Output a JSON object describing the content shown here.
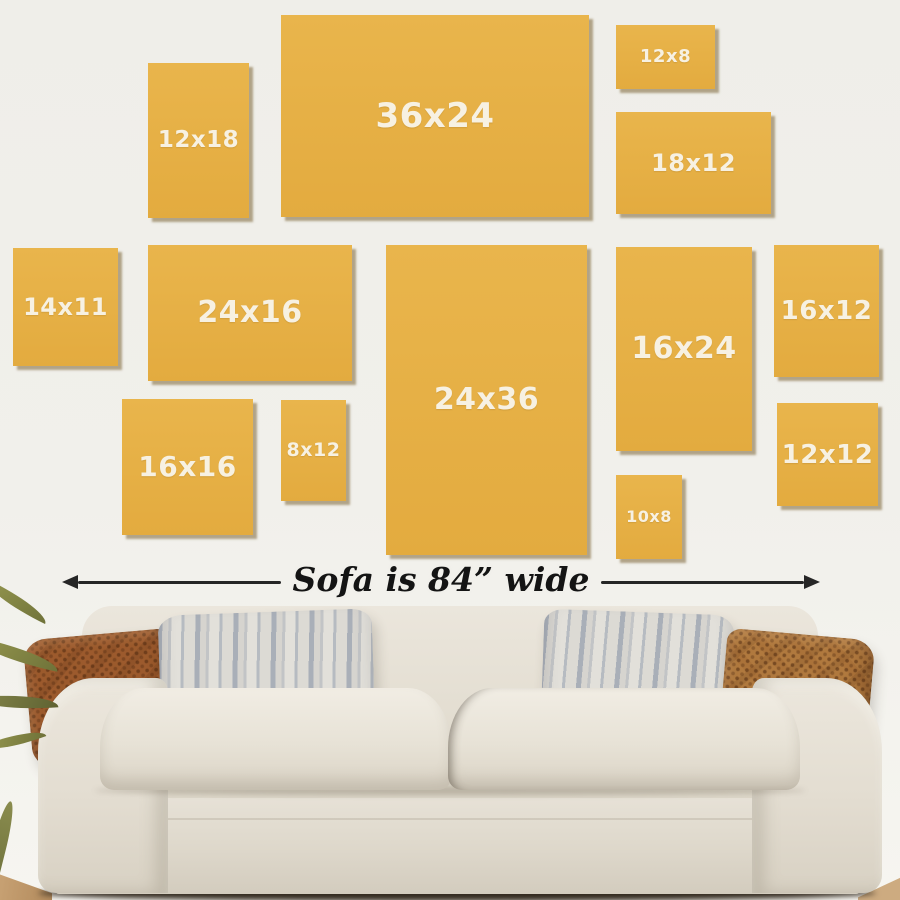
{
  "scene": {
    "description": "Wall art size guide above an 84 inch wide sofa",
    "wall_color": "#f0efea",
    "frame_color": "#e9b54c",
    "frame_label_color": "#f7f1e2",
    "arrow_color": "#262626",
    "sofa_color": "#e8e3d8",
    "pillow_colors": {
      "rust": "#9c5a2d",
      "tan": "#b0793e",
      "stripe_gray": "#aab0b8"
    }
  },
  "size_guide": {
    "frames": [
      {
        "label": "12x18",
        "x": 148,
        "y": 63,
        "w": 101,
        "h": 155,
        "fs": 23
      },
      {
        "label": "36x24",
        "x": 281,
        "y": 15,
        "w": 308,
        "h": 202,
        "fs": 34
      },
      {
        "label": "12x8",
        "x": 616,
        "y": 25,
        "w": 99,
        "h": 64,
        "fs": 18
      },
      {
        "label": "18x12",
        "x": 616,
        "y": 112,
        "w": 155,
        "h": 102,
        "fs": 24
      },
      {
        "label": "14x11",
        "x": 13,
        "y": 248,
        "w": 105,
        "h": 118,
        "fs": 24
      },
      {
        "label": "24x16",
        "x": 148,
        "y": 245,
        "w": 204,
        "h": 136,
        "fs": 30
      },
      {
        "label": "24x36",
        "x": 386,
        "y": 245,
        "w": 201,
        "h": 310,
        "fs": 30
      },
      {
        "label": "16x24",
        "x": 616,
        "y": 247,
        "w": 136,
        "h": 204,
        "fs": 30
      },
      {
        "label": "16x12",
        "x": 774,
        "y": 245,
        "w": 105,
        "h": 132,
        "fs": 26
      },
      {
        "label": "16x16",
        "x": 122,
        "y": 399,
        "w": 131,
        "h": 136,
        "fs": 28
      },
      {
        "label": "8x12",
        "x": 281,
        "y": 400,
        "w": 65,
        "h": 101,
        "fs": 19
      },
      {
        "label": "10x8",
        "x": 616,
        "y": 475,
        "w": 66,
        "h": 84,
        "fs": 16
      },
      {
        "label": "12x12",
        "x": 777,
        "y": 403,
        "w": 101,
        "h": 103,
        "fs": 26
      }
    ]
  },
  "dimension": {
    "label": "Sofa is 84” wide"
  }
}
